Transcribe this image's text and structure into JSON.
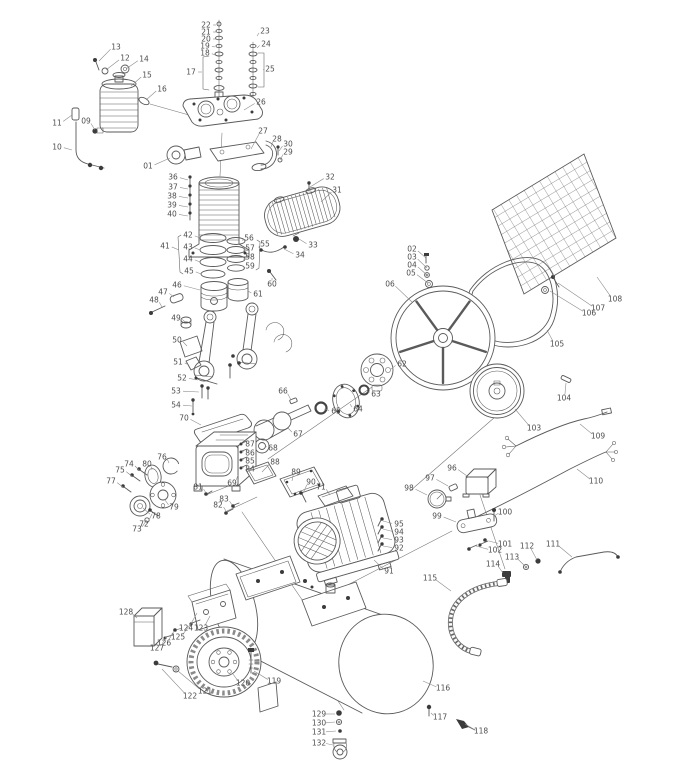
{
  "meta": {
    "background": "#ffffff",
    "line_color": "#5a5a5a",
    "label_color": "#4d4d4d",
    "total_labels": 129
  },
  "parts": [
    {
      "n": "01",
      "x": 148,
      "y": 166,
      "tx": 170,
      "ty": 158
    },
    {
      "n": "02",
      "x": 412,
      "y": 249,
      "tx": 426,
      "ty": 258
    },
    {
      "n": "03",
      "x": 412,
      "y": 257,
      "tx": 427,
      "ty": 268
    },
    {
      "n": "04",
      "x": 412,
      "y": 265,
      "tx": 427,
      "ty": 275
    },
    {
      "n": "05",
      "x": 411,
      "y": 273,
      "tx": 428,
      "ty": 283
    },
    {
      "n": "06",
      "x": 390,
      "y": 284,
      "tx": 412,
      "ty": 302
    },
    {
      "n": "09",
      "x": 86,
      "y": 121,
      "tx": 95,
      "ty": 130
    },
    {
      "n": "10",
      "x": 57,
      "y": 147,
      "tx": 72,
      "ty": 150
    },
    {
      "n": "11",
      "x": 57,
      "y": 123,
      "tx": 72,
      "ty": 115
    },
    {
      "n": "12",
      "x": 125,
      "y": 58,
      "tx": 106,
      "ty": 70
    },
    {
      "n": "13",
      "x": 116,
      "y": 47,
      "tx": 99,
      "ty": 61
    },
    {
      "n": "14",
      "x": 144,
      "y": 59,
      "tx": 126,
      "ty": 69
    },
    {
      "n": "15",
      "x": 147,
      "y": 75,
      "tx": 131,
      "ty": 86
    },
    {
      "n": "16",
      "x": 162,
      "y": 89,
      "tx": 146,
      "ty": 100
    },
    {
      "n": "17",
      "x": 191,
      "y": 72,
      "tx": 202,
      "ty": 72
    },
    {
      "n": "18",
      "x": 205,
      "y": 53,
      "tx": 215,
      "ty": 55
    },
    {
      "n": "19",
      "x": 205,
      "y": 46,
      "tx": 215,
      "ty": 47
    },
    {
      "n": "20",
      "x": 206,
      "y": 39,
      "tx": 216,
      "ty": 39
    },
    {
      "n": "21",
      "x": 206,
      "y": 32,
      "tx": 216,
      "ty": 32
    },
    {
      "n": "22",
      "x": 206,
      "y": 25,
      "tx": 216,
      "ty": 25
    },
    {
      "n": "23",
      "x": 265,
      "y": 31,
      "tx": 257,
      "ty": 36
    },
    {
      "n": "24",
      "x": 266,
      "y": 44,
      "tx": 257,
      "ty": 48
    },
    {
      "n": "25",
      "x": 270,
      "y": 69,
      "tx": 264,
      "ty": 70
    },
    {
      "n": "26",
      "x": 261,
      "y": 102,
      "tx": 244,
      "ty": 110
    },
    {
      "n": "27",
      "x": 263,
      "y": 131,
      "tx": 251,
      "ty": 149
    },
    {
      "n": "28",
      "x": 277,
      "y": 139,
      "tx": 271,
      "ty": 147
    },
    {
      "n": "29",
      "x": 288,
      "y": 152,
      "tx": 280,
      "ty": 160
    },
    {
      "n": "30",
      "x": 288,
      "y": 144,
      "tx": 279,
      "ty": 151
    },
    {
      "n": "31",
      "x": 337,
      "y": 190,
      "tx": 321,
      "ty": 202
    },
    {
      "n": "32",
      "x": 330,
      "y": 177,
      "tx": 310,
      "ty": 187
    },
    {
      "n": "33",
      "x": 313,
      "y": 245,
      "tx": 299,
      "ty": 239
    },
    {
      "n": "34",
      "x": 300,
      "y": 255,
      "tx": 284,
      "ty": 249
    },
    {
      "n": "36",
      "x": 173,
      "y": 177,
      "tx": 188,
      "ty": 180
    },
    {
      "n": "37",
      "x": 173,
      "y": 187,
      "tx": 188,
      "ty": 189
    },
    {
      "n": "38",
      "x": 172,
      "y": 196,
      "tx": 188,
      "ty": 198
    },
    {
      "n": "39",
      "x": 172,
      "y": 205,
      "tx": 188,
      "ty": 207
    },
    {
      "n": "40",
      "x": 172,
      "y": 214,
      "tx": 188,
      "ty": 216
    },
    {
      "n": "41",
      "x": 165,
      "y": 246,
      "tx": 179,
      "ty": 250
    },
    {
      "n": "42",
      "x": 188,
      "y": 235,
      "tx": 200,
      "ty": 238
    },
    {
      "n": "43",
      "x": 188,
      "y": 247,
      "tx": 200,
      "ty": 250
    },
    {
      "n": "44",
      "x": 188,
      "y": 259,
      "tx": 200,
      "ty": 262
    },
    {
      "n": "45",
      "x": 189,
      "y": 271,
      "tx": 201,
      "ty": 274
    },
    {
      "n": "46",
      "x": 177,
      "y": 285,
      "tx": 200,
      "ty": 290
    },
    {
      "n": "47",
      "x": 163,
      "y": 292,
      "tx": 174,
      "ty": 297
    },
    {
      "n": "48",
      "x": 154,
      "y": 300,
      "tx": 162,
      "ty": 307
    },
    {
      "n": "49",
      "x": 176,
      "y": 318,
      "tx": 185,
      "ty": 322
    },
    {
      "n": "50",
      "x": 177,
      "y": 340,
      "tx": 187,
      "ty": 346
    },
    {
      "n": "51",
      "x": 178,
      "y": 362,
      "tx": 189,
      "ty": 365
    },
    {
      "n": "52",
      "x": 182,
      "y": 378,
      "tx": 198,
      "ty": 380
    },
    {
      "n": "53",
      "x": 176,
      "y": 391,
      "tx": 199,
      "ty": 392
    },
    {
      "n": "54",
      "x": 176,
      "y": 405,
      "tx": 192,
      "ty": 406
    },
    {
      "n": "55",
      "x": 265,
      "y": 244,
      "tx": 259,
      "ty": 248
    },
    {
      "n": "56",
      "x": 249,
      "y": 238,
      "tx": 243,
      "ty": 241
    },
    {
      "n": "57",
      "x": 250,
      "y": 248,
      "tx": 244,
      "ty": 251
    },
    {
      "n": "58",
      "x": 250,
      "y": 257,
      "tx": 244,
      "ty": 260
    },
    {
      "n": "59",
      "x": 250,
      "y": 266,
      "tx": 244,
      "ty": 269
    },
    {
      "n": "60",
      "x": 272,
      "y": 284,
      "tx": 272,
      "ty": 278
    },
    {
      "n": "61",
      "x": 258,
      "y": 294,
      "tx": 248,
      "ty": 291
    },
    {
      "n": "62",
      "x": 402,
      "y": 364,
      "tx": 391,
      "ty": 369
    },
    {
      "n": "63",
      "x": 376,
      "y": 394,
      "tx": 367,
      "ty": 391
    },
    {
      "n": "64",
      "x": 358,
      "y": 409,
      "tx": 350,
      "ty": 404
    },
    {
      "n": "65",
      "x": 336,
      "y": 411,
      "tx": 324,
      "ty": 409
    },
    {
      "n": "66",
      "x": 283,
      "y": 391,
      "tx": 291,
      "ty": 400
    },
    {
      "n": "67",
      "x": 298,
      "y": 434,
      "tx": 288,
      "ty": 428
    },
    {
      "n": "68",
      "x": 273,
      "y": 448,
      "tx": 266,
      "ty": 446
    },
    {
      "n": "69",
      "x": 232,
      "y": 483,
      "tx": 238,
      "ty": 475
    },
    {
      "n": "70",
      "x": 184,
      "y": 418,
      "tx": 201,
      "ty": 425
    },
    {
      "n": "71",
      "x": 321,
      "y": 487,
      "tx": 330,
      "ty": 495
    },
    {
      "n": "72",
      "x": 144,
      "y": 524,
      "tx": 152,
      "ty": 514
    },
    {
      "n": "73",
      "x": 137,
      "y": 529,
      "tx": 146,
      "ty": 521
    },
    {
      "n": "74",
      "x": 129,
      "y": 464,
      "tx": 140,
      "ty": 471
    },
    {
      "n": "75",
      "x": 120,
      "y": 470,
      "tx": 133,
      "ty": 477
    },
    {
      "n": "76",
      "x": 162,
      "y": 457,
      "tx": 169,
      "ty": 463
    },
    {
      "n": "77",
      "x": 111,
      "y": 481,
      "tx": 124,
      "ty": 488
    },
    {
      "n": "78",
      "x": 156,
      "y": 516,
      "tx": 143,
      "ty": 508
    },
    {
      "n": "79",
      "x": 174,
      "y": 507,
      "tx": 165,
      "ty": 500
    },
    {
      "n": "80",
      "x": 147,
      "y": 464,
      "tx": 152,
      "ty": 470
    },
    {
      "n": "81",
      "x": 198,
      "y": 487,
      "tx": 206,
      "ty": 493
    },
    {
      "n": "82",
      "x": 218,
      "y": 505,
      "tx": 226,
      "ty": 511
    },
    {
      "n": "83",
      "x": 224,
      "y": 499,
      "tx": 232,
      "ty": 505
    },
    {
      "n": "84",
      "x": 250,
      "y": 469,
      "tx": 243,
      "ty": 467
    },
    {
      "n": "85",
      "x": 250,
      "y": 461,
      "tx": 243,
      "ty": 459
    },
    {
      "n": "86",
      "x": 250,
      "y": 453,
      "tx": 243,
      "ty": 451
    },
    {
      "n": "87",
      "x": 250,
      "y": 444,
      "tx": 243,
      "ty": 443
    },
    {
      "n": "88",
      "x": 275,
      "y": 462,
      "tx": 262,
      "ty": 472
    },
    {
      "n": "89",
      "x": 296,
      "y": 472,
      "tx": 292,
      "ty": 481
    },
    {
      "n": "90",
      "x": 311,
      "y": 482,
      "tx": 303,
      "ty": 493
    },
    {
      "n": "91",
      "x": 389,
      "y": 571,
      "tx": 374,
      "ty": 560
    },
    {
      "n": "92",
      "x": 399,
      "y": 548,
      "tx": 383,
      "ty": 546
    },
    {
      "n": "93",
      "x": 399,
      "y": 540,
      "tx": 383,
      "ty": 538
    },
    {
      "n": "94",
      "x": 399,
      "y": 532,
      "tx": 383,
      "ty": 529
    },
    {
      "n": "95",
      "x": 399,
      "y": 524,
      "tx": 383,
      "ty": 521
    },
    {
      "n": "96",
      "x": 452,
      "y": 468,
      "tx": 467,
      "ty": 476
    },
    {
      "n": "97",
      "x": 430,
      "y": 478,
      "tx": 448,
      "ty": 486
    },
    {
      "n": "98",
      "x": 409,
      "y": 488,
      "tx": 427,
      "ty": 495
    },
    {
      "n": "99",
      "x": 437,
      "y": 516,
      "tx": 456,
      "ty": 522
    },
    {
      "n": "100",
      "x": 505,
      "y": 512,
      "tx": 494,
      "ty": 516
    },
    {
      "n": "101",
      "x": 505,
      "y": 544,
      "tx": 489,
      "ty": 541
    },
    {
      "n": "102",
      "x": 495,
      "y": 550,
      "tx": 476,
      "ty": 546
    },
    {
      "n": "103",
      "x": 534,
      "y": 428,
      "tx": 515,
      "ty": 409
    },
    {
      "n": "104",
      "x": 564,
      "y": 398,
      "tx": 566,
      "ty": 383
    },
    {
      "n": "105",
      "x": 557,
      "y": 344,
      "tx": 547,
      "ty": 330
    },
    {
      "n": "106",
      "x": 589,
      "y": 313,
      "tx": 550,
      "ty": 291
    },
    {
      "n": "107",
      "x": 598,
      "y": 308,
      "tx": 558,
      "ty": 283
    },
    {
      "n": "108",
      "x": 615,
      "y": 299,
      "tx": 597,
      "ty": 277
    },
    {
      "n": "109",
      "x": 598,
      "y": 436,
      "tx": 580,
      "ty": 424
    },
    {
      "n": "110",
      "x": 596,
      "y": 481,
      "tx": 577,
      "ty": 469
    },
    {
      "n": "111",
      "x": 553,
      "y": 544,
      "tx": 572,
      "ty": 557
    },
    {
      "n": "112",
      "x": 527,
      "y": 546,
      "tx": 537,
      "ty": 560
    },
    {
      "n": "113",
      "x": 512,
      "y": 557,
      "tx": 525,
      "ty": 566
    },
    {
      "n": "114",
      "x": 493,
      "y": 564,
      "tx": 503,
      "ty": 573
    },
    {
      "n": "115",
      "x": 430,
      "y": 578,
      "tx": 451,
      "ty": 591
    },
    {
      "n": "116",
      "x": 443,
      "y": 688,
      "tx": 423,
      "ty": 681
    },
    {
      "n": "117",
      "x": 440,
      "y": 717,
      "tx": 431,
      "ty": 713
    },
    {
      "n": "118",
      "x": 481,
      "y": 731,
      "tx": 465,
      "ty": 724
    },
    {
      "n": "119",
      "x": 274,
      "y": 681,
      "tx": 254,
      "ty": 671
    },
    {
      "n": "120",
      "x": 243,
      "y": 683,
      "tx": 233,
      "ty": 674
    },
    {
      "n": "121",
      "x": 205,
      "y": 691,
      "tx": 178,
      "ty": 671
    },
    {
      "n": "122",
      "x": 190,
      "y": 696,
      "tx": 162,
      "ty": 669
    },
    {
      "n": "123",
      "x": 201,
      "y": 628,
      "tx": 210,
      "ty": 616
    },
    {
      "n": "124",
      "x": 186,
      "y": 628,
      "tx": 197,
      "ty": 613
    },
    {
      "n": "125",
      "x": 178,
      "y": 637,
      "tx": 192,
      "ty": 622
    },
    {
      "n": "126",
      "x": 164,
      "y": 643,
      "tx": 174,
      "ty": 631
    },
    {
      "n": "127",
      "x": 157,
      "y": 648,
      "tx": 166,
      "ty": 637
    },
    {
      "n": "128",
      "x": 126,
      "y": 612,
      "tx": 137,
      "ty": 618
    },
    {
      "n": "129",
      "x": 319,
      "y": 714,
      "tx": 335,
      "ty": 714
    },
    {
      "n": "130",
      "x": 319,
      "y": 723,
      "tx": 335,
      "ty": 722
    },
    {
      "n": "131",
      "x": 319,
      "y": 732,
      "tx": 336,
      "ty": 731
    },
    {
      "n": "132",
      "x": 319,
      "y": 743,
      "tx": 333,
      "ty": 745
    }
  ]
}
